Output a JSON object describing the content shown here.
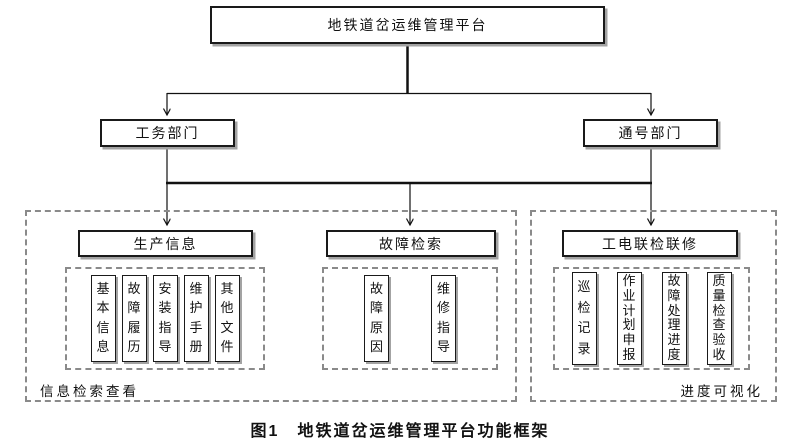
{
  "colors": {
    "border": "#1a1a1a",
    "shadow": "#a3a3a3",
    "dash": "#8a8a8a",
    "text": "#111111",
    "background": "#ffffff"
  },
  "diagram": {
    "root": {
      "label": "地铁道岔运维管理平台"
    },
    "departments": [
      {
        "label": "工务部门"
      },
      {
        "label": "通号部门"
      }
    ],
    "sections": [
      {
        "header": "生产信息",
        "items": [
          "基本信息",
          "故障履历",
          "安装指导",
          "维护手册",
          "其他文件"
        ]
      },
      {
        "header": "故障检索",
        "items": [
          "故障原因",
          "维修指导"
        ]
      },
      {
        "header": "工电联检联修",
        "items": [
          "巡检记录",
          "作业计划申报",
          "故障处理进度",
          "质量检查验收"
        ]
      }
    ],
    "zone_labels": {
      "left": "信息检索查看",
      "right": "进度可视化"
    },
    "caption": "图1　地铁道岔运维管理平台功能框架"
  }
}
